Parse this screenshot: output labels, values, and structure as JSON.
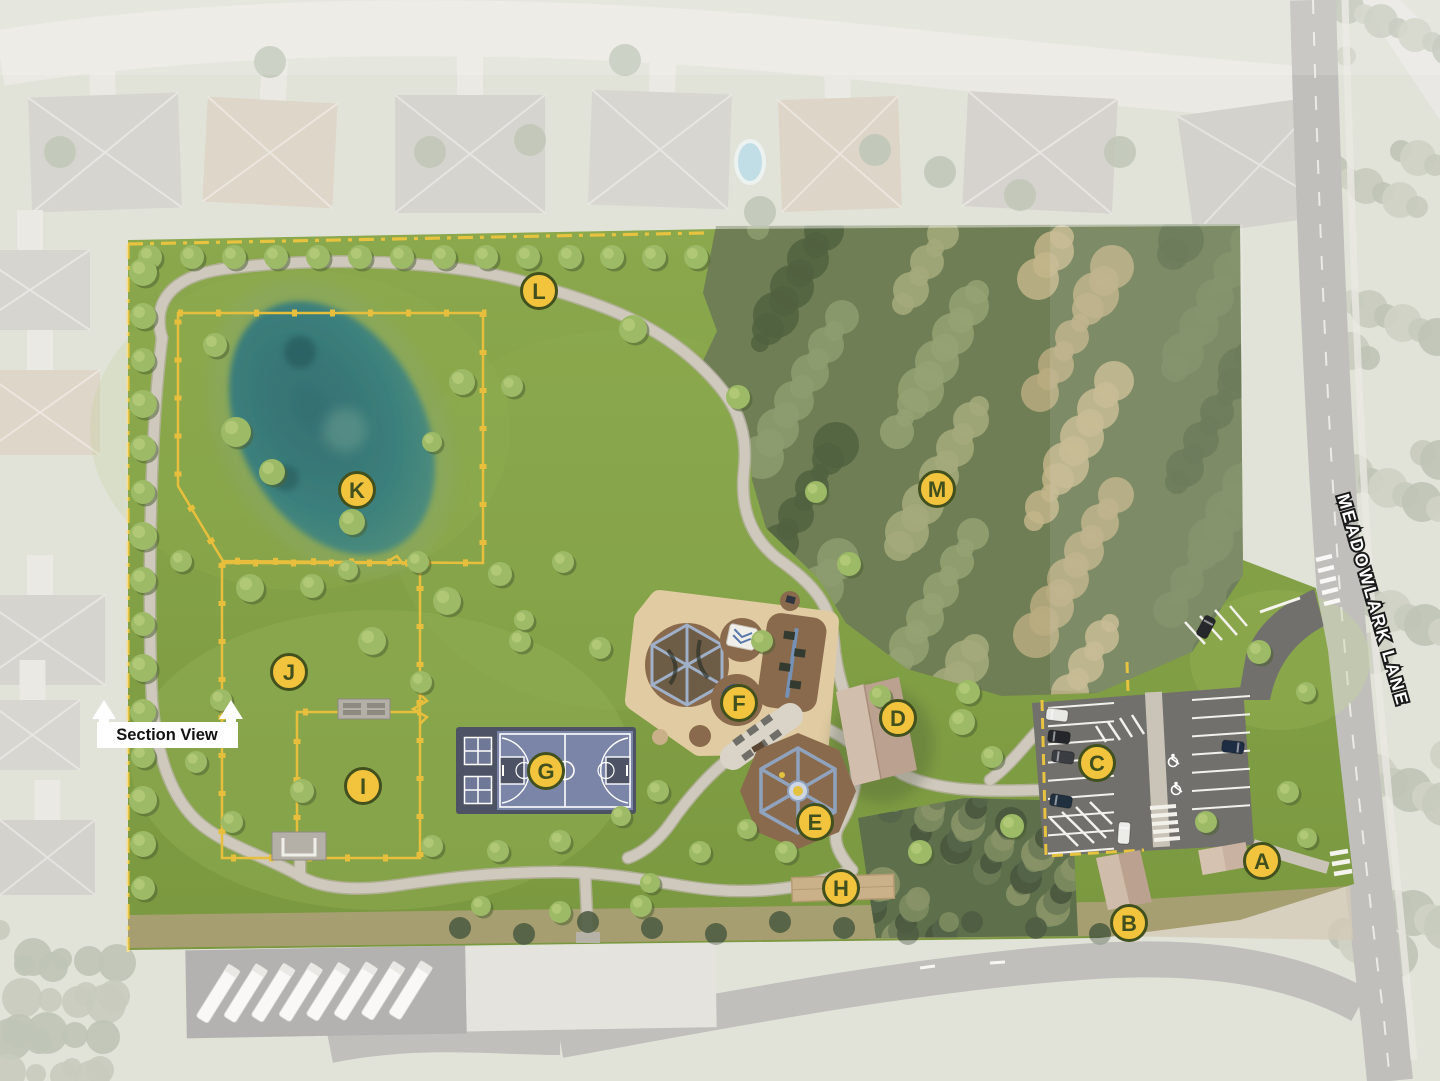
{
  "map": {
    "section_view_label": "Section View",
    "street_label": "MEADOWLARK LANE",
    "marker_style": {
      "fill": "#F2C43D",
      "stroke": "#42501E",
      "radius": 17.5
    },
    "markers": [
      {
        "letter": "A",
        "x": 1262,
        "y": 861
      },
      {
        "letter": "B",
        "x": 1129,
        "y": 923
      },
      {
        "letter": "C",
        "x": 1097,
        "y": 763
      },
      {
        "letter": "D",
        "x": 898,
        "y": 718
      },
      {
        "letter": "E",
        "x": 815,
        "y": 822
      },
      {
        "letter": "F",
        "x": 739,
        "y": 703
      },
      {
        "letter": "G",
        "x": 546,
        "y": 771
      },
      {
        "letter": "H",
        "x": 841,
        "y": 888
      },
      {
        "letter": "I",
        "x": 363,
        "y": 786
      },
      {
        "letter": "J",
        "x": 289,
        "y": 672
      },
      {
        "letter": "K",
        "x": 357,
        "y": 490
      },
      {
        "letter": "L",
        "x": 539,
        "y": 291
      },
      {
        "letter": "M",
        "x": 937,
        "y": 489
      }
    ],
    "colors": {
      "park_green": "#84A148",
      "forest_green": "#6F7E55",
      "pond_teal": "#33726F",
      "fence_yellow": "#E8BF3C",
      "boundary_yellow": "#E7C33F",
      "trail_gray": "#CFC9BD",
      "court_blue": "#7B85A7",
      "asphalt_gray": "#71706C"
    }
  }
}
